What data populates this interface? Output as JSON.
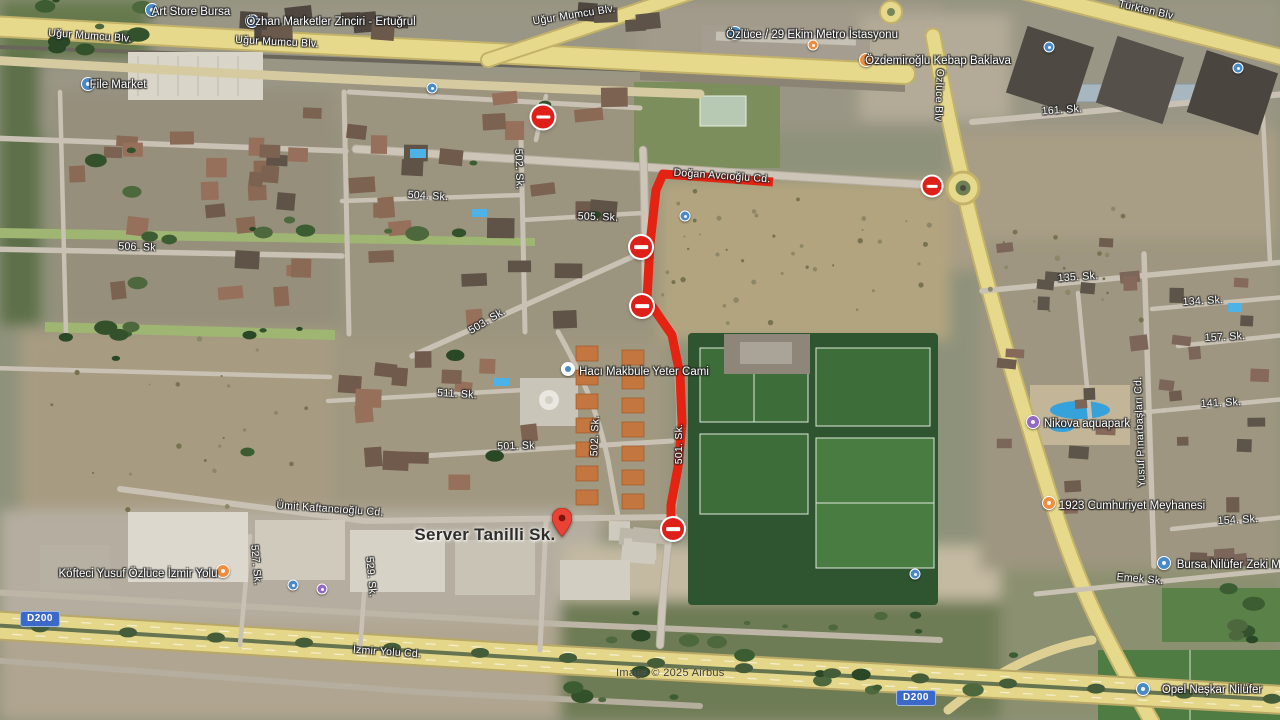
{
  "map": {
    "attribution": "Image © 2025 Airbus",
    "road_shield": "D200",
    "colors": {
      "route": "#e42313",
      "closure": "#df2018",
      "poi_blue": "#4889c8",
      "poi_orange": "#ef8d3e",
      "poi_purple": "#9268c5",
      "shield_bg": "#3c68c8",
      "shield_border": "#9db9e8"
    },
    "main_label": {
      "text": "Server Tanilli Sk.",
      "x": 485,
      "y": 535
    },
    "pin": {
      "x": 562,
      "y": 542
    },
    "route": {
      "points": "773,182 663,174 656,190 650,244 647,299 672,335 680,375 682,423 678,467 671,505 671,522",
      "width": 9
    },
    "closures": [
      {
        "x": 543,
        "y": 117,
        "d": 23
      },
      {
        "x": 641,
        "y": 247,
        "d": 22
      },
      {
        "x": 642,
        "y": 306,
        "d": 22
      },
      {
        "x": 673,
        "y": 529,
        "d": 22
      },
      {
        "x": 932,
        "y": 186,
        "d": 19
      }
    ],
    "shields": [
      {
        "x": 40,
        "y": 619
      },
      {
        "x": 916,
        "y": 698
      }
    ],
    "road_labels": [
      {
        "text": "Uğur Mumcu Blv.",
        "x": 90,
        "y": 36,
        "rot": 4
      },
      {
        "text": "Uğur Mumcu Blv.",
        "x": 277,
        "y": 42,
        "rot": 3
      },
      {
        "text": "Uğur Mumcu Blv.",
        "x": 574,
        "y": 15,
        "rot": -9
      },
      {
        "text": "Türkten Blv",
        "x": 1146,
        "y": 10,
        "rot": 13
      },
      {
        "text": "Doğan Avcıoğlu Cd.",
        "x": 722,
        "y": 176,
        "rot": 4
      },
      {
        "text": "Özlüce Blv",
        "x": 939,
        "y": 95,
        "rot": 92
      },
      {
        "text": "161. Sk.",
        "x": 1062,
        "y": 110,
        "rot": -4
      },
      {
        "text": "506. Sk",
        "x": 137,
        "y": 247,
        "rot": 2
      },
      {
        "text": "504. Sk.",
        "x": 428,
        "y": 196,
        "rot": 3
      },
      {
        "text": "505. Sk.",
        "x": 598,
        "y": 217,
        "rot": 2
      },
      {
        "text": "502. Sk.",
        "x": 519,
        "y": 169,
        "rot": 88
      },
      {
        "text": "503. Sk.",
        "x": 487,
        "y": 321,
        "rot": -31
      },
      {
        "text": "511. Sk.",
        "x": 457,
        "y": 394,
        "rot": 3
      },
      {
        "text": "502. Sk.",
        "x": 595,
        "y": 436,
        "rot": -88
      },
      {
        "text": "501. Sk",
        "x": 516,
        "y": 446,
        "rot": -2
      },
      {
        "text": "501. Sk.",
        "x": 679,
        "y": 444,
        "rot": -90
      },
      {
        "text": "527. Sk.",
        "x": 256,
        "y": 565,
        "rot": 85
      },
      {
        "text": "529. Sk.",
        "x": 371,
        "y": 577,
        "rot": 85
      },
      {
        "text": "Ümit Kaftancıoğlu Cd.",
        "x": 330,
        "y": 509,
        "rot": 4
      },
      {
        "text": "İzmir Yolu Cd.",
        "x": 387,
        "y": 652,
        "rot": 4
      },
      {
        "text": "135. Sk.",
        "x": 1078,
        "y": 277,
        "rot": -4
      },
      {
        "text": "134. Sk.",
        "x": 1203,
        "y": 301,
        "rot": -3
      },
      {
        "text": "157. Sk.",
        "x": 1225,
        "y": 337,
        "rot": -3
      },
      {
        "text": "141. Sk.",
        "x": 1221,
        "y": 403,
        "rot": -3
      },
      {
        "text": "154. Sk.",
        "x": 1238,
        "y": 520,
        "rot": -3
      },
      {
        "text": "Yusuf Pınarbaşları Cd.",
        "x": 1140,
        "y": 432,
        "rot": -92
      },
      {
        "text": "Emek Sk.",
        "x": 1140,
        "y": 579,
        "rot": 5
      }
    ],
    "pois": [
      {
        "id": "art-store-bursa",
        "text": "Art Store Bursa",
        "lx": 191,
        "ly": 12,
        "ix": 152,
        "iy": 10,
        "c": "blue"
      },
      {
        "id": "ozhan-marketler-zinciri",
        "text": "Özhan Marketler Zinciri - Ertuğrul",
        "lx": 331,
        "ly": 22,
        "ix": 252,
        "iy": 21,
        "c": "blue"
      },
      {
        "id": "file-market",
        "text": "File Market",
        "lx": 118,
        "ly": 85,
        "ix": 88,
        "iy": 84,
        "c": "blue"
      },
      {
        "id": "ozluce-29-ekim-metro",
        "text": "Özlüce / 29 Ekim Metro İstasyonu",
        "lx": 812,
        "ly": 35,
        "ix": 735,
        "iy": 33,
        "c": "blue"
      },
      {
        "id": "ozdemiroglu-kebap-baklava",
        "text": "Özdemiroğlu Kebap Baklava",
        "lx": 938,
        "ly": 61,
        "ix": 866,
        "iy": 60,
        "c": "orange"
      },
      {
        "id": "haci-makbule-yeter-cami",
        "text": "Hacı Makbule Yeter Cami",
        "lx": 644,
        "ly": 372,
        "ix": 568,
        "iy": 369,
        "c": "mosque"
      },
      {
        "id": "kofteci-yusuf-ozluce",
        "text": "Köfteci Yusuf Özlüce İzmir Yolu",
        "lx": 138,
        "ly": 574,
        "ix": 223,
        "iy": 571,
        "c": "orange"
      },
      {
        "id": "nikova-aquapark",
        "text": "Nikova aquapark",
        "lx": 1087,
        "ly": 424,
        "ix": 1033,
        "iy": 422,
        "c": "purple"
      },
      {
        "id": "1923-cumhuriyet-meyhanesi",
        "text": "1923 Cumhuriyet Meyhanesi",
        "lx": 1132,
        "ly": 506,
        "ix": 1049,
        "iy": 503,
        "c": "orange"
      },
      {
        "id": "bursa-nilufer-zeki",
        "text": "Bursa Nilüfer Zeki Mü",
        "lx": 1232,
        "ly": 565,
        "ix": 1164,
        "iy": 563,
        "c": "blue"
      },
      {
        "id": "opel-neskar-nilufer",
        "text": "Opel Neşkar Nilüfer",
        "lx": 1212,
        "ly": 690,
        "ix": 1143,
        "iy": 689,
        "c": "blue"
      }
    ],
    "poi_dots": [
      {
        "x": 432,
        "y": 88,
        "c": "blue"
      },
      {
        "x": 685,
        "y": 216,
        "c": "blue"
      },
      {
        "x": 1049,
        "y": 47,
        "c": "blue"
      },
      {
        "x": 1238,
        "y": 68,
        "c": "blue"
      },
      {
        "x": 915,
        "y": 574,
        "c": "blue"
      },
      {
        "x": 293,
        "y": 585,
        "c": "blue"
      },
      {
        "x": 322,
        "y": 589,
        "c": "purple"
      },
      {
        "x": 813,
        "y": 45,
        "c": "orange"
      }
    ]
  }
}
